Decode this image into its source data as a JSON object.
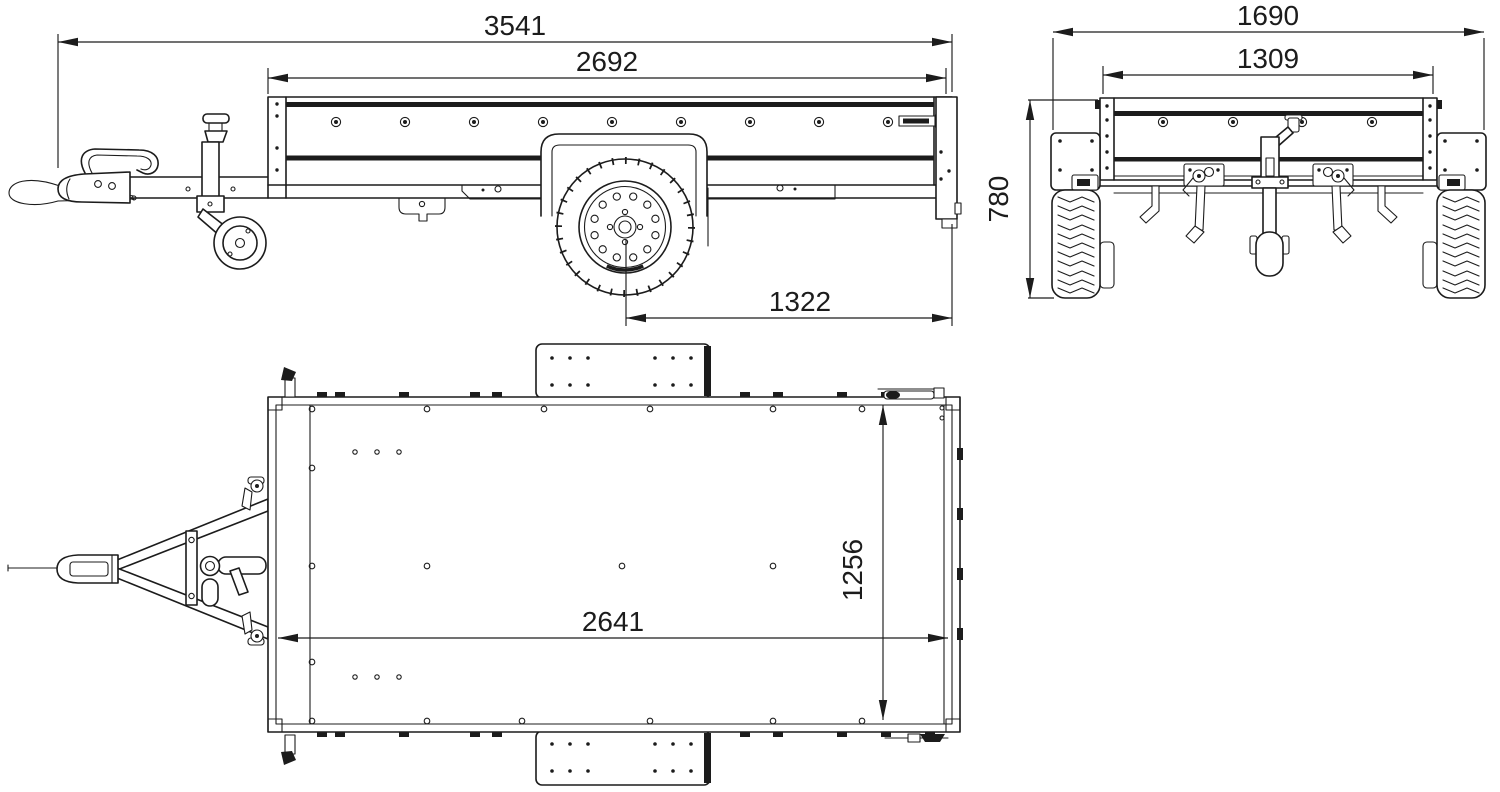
{
  "drawing": {
    "background_color": "#ffffff",
    "line_color": "#1c1c1c",
    "views": {
      "side": {
        "dimensions": {
          "overall_length": "3541",
          "body_length": "2692",
          "axle_to_rear": "1322"
        }
      },
      "front": {
        "dimensions": {
          "overall_width": "1690",
          "body_width": "1309",
          "body_height": "780"
        }
      },
      "top": {
        "dimensions": {
          "inner_length": "2641",
          "inner_width": "1256"
        }
      }
    }
  }
}
